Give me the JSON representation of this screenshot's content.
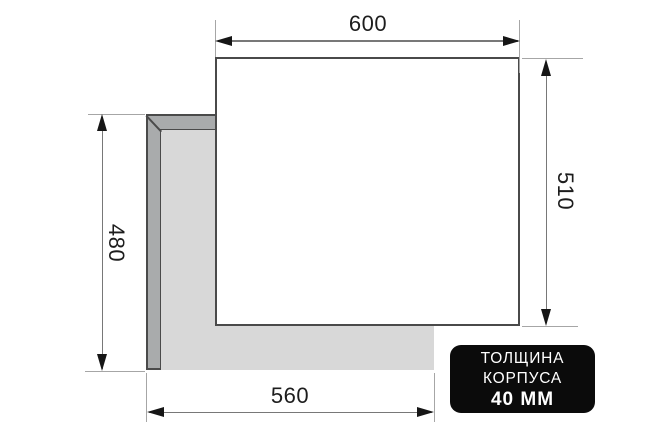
{
  "diagram": {
    "type": "cooktop-installation-dimensions",
    "labels": {
      "top_width_mm": "600",
      "right_depth_mm": "510",
      "left_depth_mm": "480",
      "bottom_width_mm": "560"
    },
    "badge": {
      "line1": "ТОЛЩИНА",
      "line2": "КОРПУСА",
      "line3": "40 ММ"
    },
    "colors": {
      "panel_fill": "#ffffff",
      "body_edge_fill": "#a9abac",
      "body_inner_fill": "#d8d8d8",
      "outline": "#4a4a4a",
      "extension_line": "#a6a6a6",
      "dimension_line": "#787878",
      "arrowhead": "#161616",
      "label_text": "#1d1d1d",
      "badge_background": "#0b0b0b",
      "badge_text": "#ffffff"
    }
  }
}
